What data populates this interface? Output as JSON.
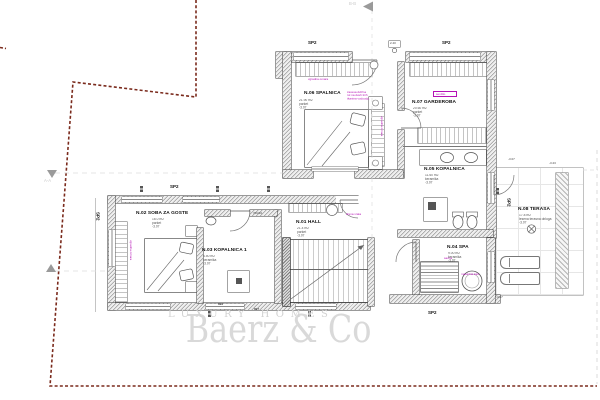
{
  "colors": {
    "boundary": "#7a2a1c",
    "annotation": "#b511b5",
    "wall": "#555555",
    "watermark": "#d9d9d9"
  },
  "watermark": {
    "brand": "Baerz & Co",
    "tagline": "LUXURY HOMES"
  },
  "sections": {
    "aa": "A-A",
    "bb": "B-B"
  },
  "tags": {
    "sp2": "SP2",
    "dim_899": "899",
    "dim_897": "897",
    "door_size": "70/210",
    "entry_flag": "2.40"
  },
  "rooms": [
    {
      "id": "n01",
      "name": "N.01 HALL",
      "area": "21.4 m2",
      "finish": "parket",
      "level": "-3.07"
    },
    {
      "id": "n02",
      "name": "N.02 SOBA ZA GOSTE",
      "area": "16.0 m2",
      "finish": "parket",
      "level": "-3.07"
    },
    {
      "id": "n03",
      "name": "N.03 KOPALNICA 1",
      "area": "4.50 m2",
      "finish": "keramika",
      "level": "-3.07"
    },
    {
      "id": "n04",
      "name": "N.04 SPA",
      "area": "9.00 m2",
      "finish": "keramika",
      "level": "-3.07"
    },
    {
      "id": "n05",
      "name": "N.05 KOPALNICA",
      "area": "11.60 m2",
      "finish": "keramika",
      "level": "-3.07"
    },
    {
      "id": "n06",
      "name": "N.06 SPALNICA",
      "area": "21.90 m2",
      "finish": "parket",
      "level": "-3.07"
    },
    {
      "id": "n07",
      "name": "N.07 GARDEROBA",
      "area": "20.60 m2",
      "finish": "parket",
      "level": "-3.07"
    },
    {
      "id": "n08",
      "name": "N.08 TERASA",
      "area": "17.8 m2",
      "finish": "lesena terasna obloga",
      "level": "-3.07"
    }
  ],
  "annotations": {
    "spalnica_note_1": "zavesa dvižna",
    "spalnica_note_2": "rol na dveh tirih",
    "spalnica_note_3": "tkanina vodoodp.",
    "closet_note": "vgradna omara",
    "closet_note_vertical": "vgradna omara",
    "wardrobe_note_vertical": "vgradna omara",
    "hall_note": "drsna vrata",
    "sauna_note": "savna",
    "tub_note": "masažna kad",
    "garderoba_box_note": "senčilo"
  },
  "levels": {
    "terrace_a": "-3.07",
    "terrace_b": "-3.23",
    "terrace_c": "-3.67"
  }
}
